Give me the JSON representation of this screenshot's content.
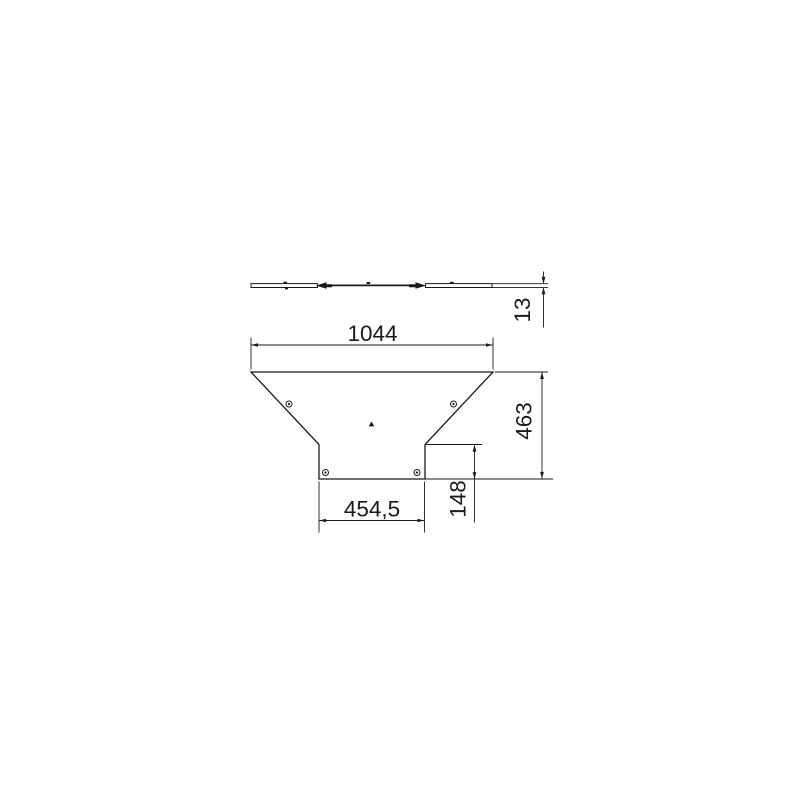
{
  "drawing": {
    "kind": "technical-dimension-drawing",
    "colors": {
      "line": "#1a1a1a",
      "background": "#ffffff"
    },
    "dimensions": {
      "overall_width": "1044",
      "thickness": "13",
      "overall_depth": "463",
      "branch_depth": "148",
      "branch_width": "454,5"
    }
  }
}
